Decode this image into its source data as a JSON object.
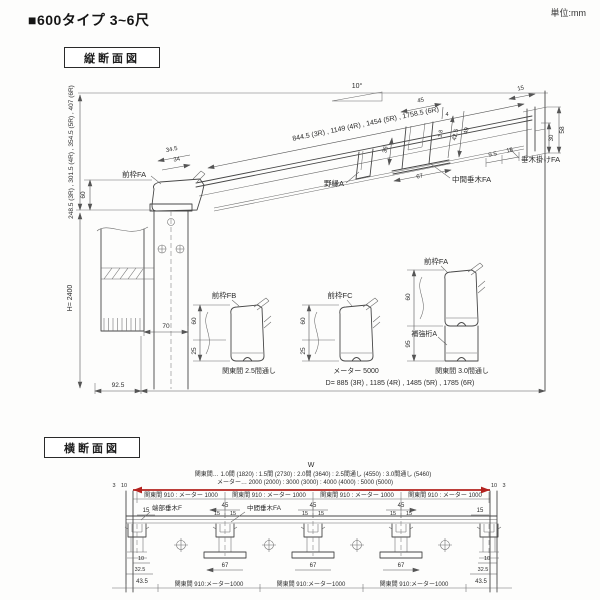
{
  "header": {
    "title": "■600タイプ 3~6尺",
    "unit": "単位:mm"
  },
  "vertical_section": {
    "box_label": "縦断面図",
    "slope": "10°",
    "dims": {
      "roof_length": "844.5 (3R) , 1149 (4R) , 1454 (5R) , 1758.5 (6R)",
      "front_height": "248.5 (3R) , 301.5 (4R) , 354.5 (5R) , 407 (6R)",
      "post_height": "H= 2400",
      "depth": "D= 885 (3R) , 1185 (4R) , 1485 (5R) , 1785 (6R)",
      "v60": "60",
      "v25": "25",
      "v95": "95",
      "v70": "70",
      "v925": "92.5",
      "v345": "34.5",
      "v34": "34",
      "v45": "45",
      "v4": "4",
      "v18": "1.8",
      "v425": "42.5",
      "v49": "49",
      "v36": "36",
      "v67": "67",
      "v15": "15",
      "v58": "58",
      "v30": "30",
      "v95b": "9.5",
      "v16": "16"
    },
    "labels": {
      "front_frame_fa": "前枠FA",
      "nobuchi_a": "野縁A",
      "mid_rafter_fa": "中間垂木FA",
      "rafter_bracket_fa": "垂木掛けFA",
      "front_frame_fb": "前枠FB",
      "front_frame_fc": "前枠FC",
      "reinforce_beam_a": "補強桁A",
      "caption_fb": "関東間 2.5間通し",
      "caption_fc": "メーター 5000",
      "caption_fa": "関東間 3.0間通し"
    }
  },
  "cross_section": {
    "box_label": "横断面図",
    "w_label": "W",
    "width_spec_kanto": "関東間… 1.0間 (1820) : 1.5間 (2730) : 2.0間 (3640) : 2.5間通し (4550) : 3.0間通し (5460)",
    "width_spec_meter": "メーター… 2000 (2000) : 3000 (3000) : 4000 (4000) : 5000 (5000)",
    "edge3": "3",
    "edge10": "10",
    "span_top": "関東間 910 : メーター 1000",
    "span_bottom": "関東間 910:メーター1000",
    "dims": {
      "c45": "45",
      "c15": "15",
      "c67": "67",
      "c10": "10",
      "c325": "32.5",
      "c435": "43.5"
    },
    "labels": {
      "end_rafter_f": "端部垂木F",
      "mid_rafter_fa": "中間垂木FA"
    }
  }
}
